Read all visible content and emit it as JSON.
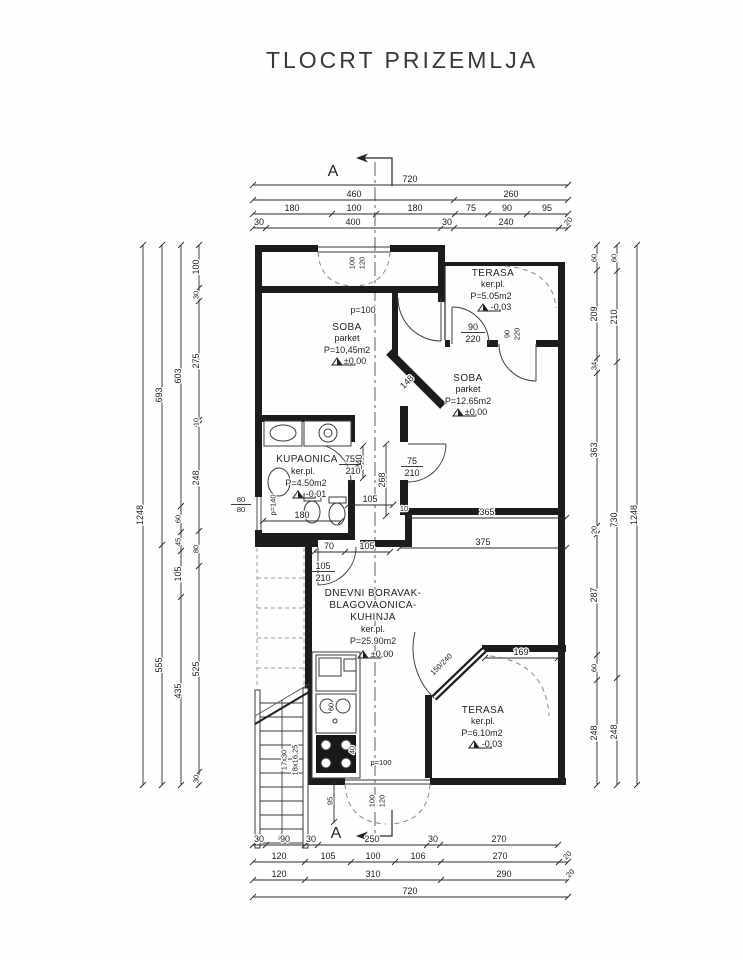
{
  "title": "TLOCRT PRIZEMLJA",
  "section_marker": "A",
  "rooms": {
    "soba1": {
      "name": "SOBA",
      "floor": "parket",
      "area": "P=10,45m2",
      "level": "±0,00",
      "parapet": "p=100"
    },
    "terasa1": {
      "name": "TERASA",
      "floor": "ker.pl.",
      "area": "P=5.05m2",
      "level": "-0,03"
    },
    "soba2": {
      "name": "SOBA",
      "floor": "parket",
      "area": "P=12.65m2",
      "level": "±0,00"
    },
    "kupaonica": {
      "name": "KUPAONICA",
      "floor": "ker.pl.",
      "area": "P=4.50m2",
      "level": "-0,01"
    },
    "dnevni": {
      "name1": "DNEVNI BORAVAK-",
      "name2": "BLAGOVAONICA-",
      "name3": "KUHINJA",
      "floor": "ker.pl.",
      "area": "P=25.90m2",
      "level": "±0,00"
    },
    "terasa2": {
      "name": "TERASA",
      "floor": "ker.pl.",
      "area": "P=6.10m2",
      "level": "-0,03"
    }
  },
  "dims": {
    "top": {
      "r1": [
        "720"
      ],
      "r2": [
        "460",
        "260"
      ],
      "r3": [
        "180",
        "100",
        "180",
        "75",
        "90",
        "95"
      ],
      "r4": [
        "30",
        "400",
        "30",
        "240",
        "20"
      ]
    },
    "bottom": {
      "r1": [
        "30",
        "90",
        "30",
        "250",
        "30",
        "270"
      ],
      "r2": [
        "120",
        "105",
        "100",
        "106",
        "270",
        "20"
      ],
      "r3": [
        "120",
        "310",
        "290",
        "20"
      ],
      "r4": [
        "720"
      ]
    },
    "left": {
      "c1": [
        "1248"
      ],
      "c2": [
        "693",
        "555"
      ],
      "c3": [
        "603",
        "60",
        "45",
        "105",
        "435"
      ],
      "c4": [
        "100",
        "30",
        "275",
        "10",
        "248",
        "80",
        "525",
        "30"
      ]
    },
    "right": {
      "a": [
        "60",
        "209",
        "34",
        "363",
        "20",
        "287",
        "60",
        "248"
      ],
      "b": [
        "60",
        "210",
        "730",
        "248"
      ],
      "c": [
        "1248"
      ]
    }
  },
  "openings": {
    "win_top_w": "100",
    "win_top_h": "120",
    "win_bot_w": "100",
    "win_bot_h": "120",
    "door_soba1_w": "90",
    "door_soba1_h": "220",
    "door_terasa1_w": "90",
    "door_terasa1_h": "220",
    "door_kup_w": "75",
    "door_kup_h": "210",
    "door_soba2_w": "75",
    "door_soba2_h": "210",
    "door_hall_w": "105",
    "door_hall_h": "210",
    "door_terasa2": "150/240",
    "win_kup_w": "80",
    "win_kup_h": "80",
    "parapet_kup": "p=140",
    "parapet_kitchen": "p=100"
  },
  "inner_dims": {
    "d365": "365",
    "d375": "375",
    "d70": "70",
    "d105_hall": "105",
    "d105_kup": "105",
    "d180": "180",
    "d268": "268",
    "d240": "240",
    "d148": "148",
    "d169": "169",
    "d10": "10",
    "d60": "60",
    "d40": "40",
    "d95": "95"
  },
  "stairs": {
    "run": "17x30",
    "rise": "18x16,25"
  }
}
